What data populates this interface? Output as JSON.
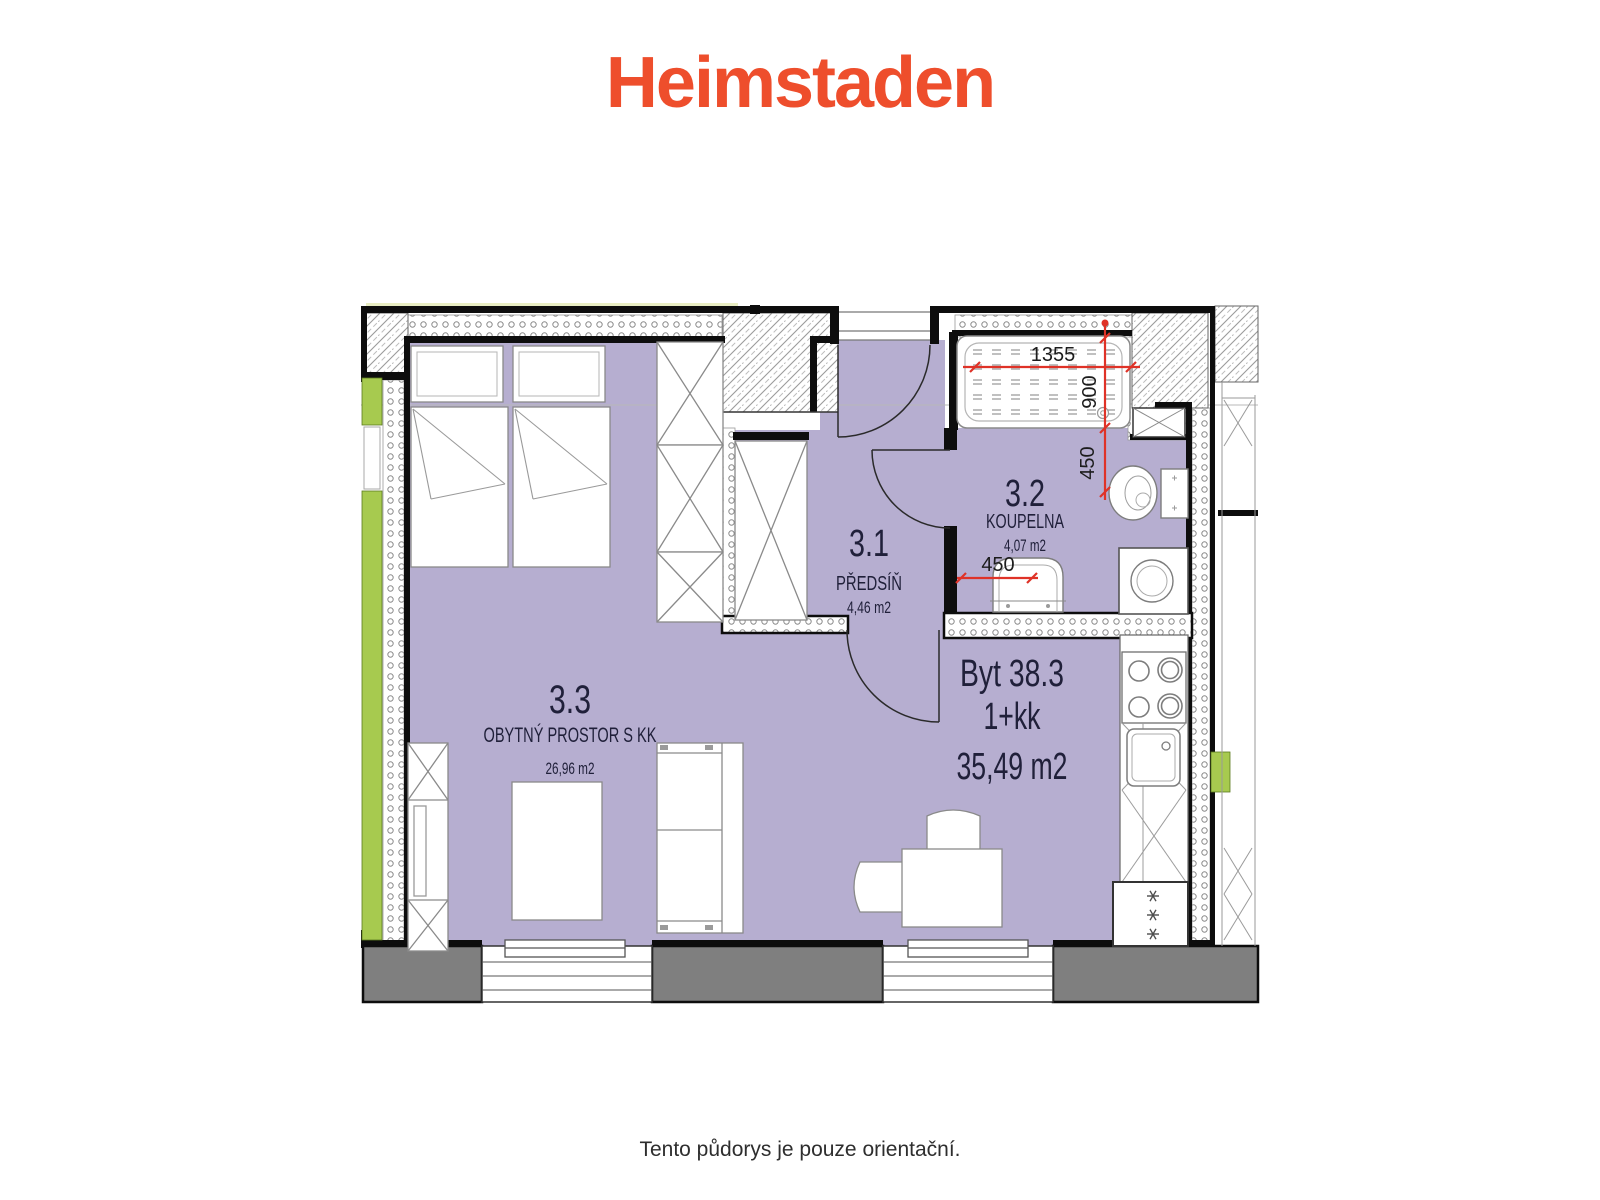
{
  "header": {
    "logo_text": "Heimstaden"
  },
  "plan": {
    "apartment": {
      "label": "Byt 38.3",
      "layout": "1+kk",
      "area": "35,49 m2"
    },
    "rooms": [
      {
        "id": "3.1",
        "name": "PŘEDSÍŇ",
        "area": "4,46 m2"
      },
      {
        "id": "3.2",
        "name": "KOUPELNA",
        "area": "4,07 m2"
      },
      {
        "id": "3.3",
        "name": "OBYTNÝ PROSTOR S KK",
        "area": "26,96 m2"
      }
    ],
    "dimensions": {
      "bathtub_width": "1355",
      "bathtub_depth": "900",
      "toilet_offset": "450",
      "basin_offset": "450"
    }
  },
  "footer": {
    "note": "Tento půdorys je pouze orientační."
  },
  "colors": {
    "logo_orange": "#ee4e2c",
    "floor_purple": "#b6aed0",
    "window_green": "#a7ca4f",
    "pale_green": "#e9edc3",
    "dimension_red": "#df3227",
    "parapet_gray": "#7f7f7f"
  }
}
